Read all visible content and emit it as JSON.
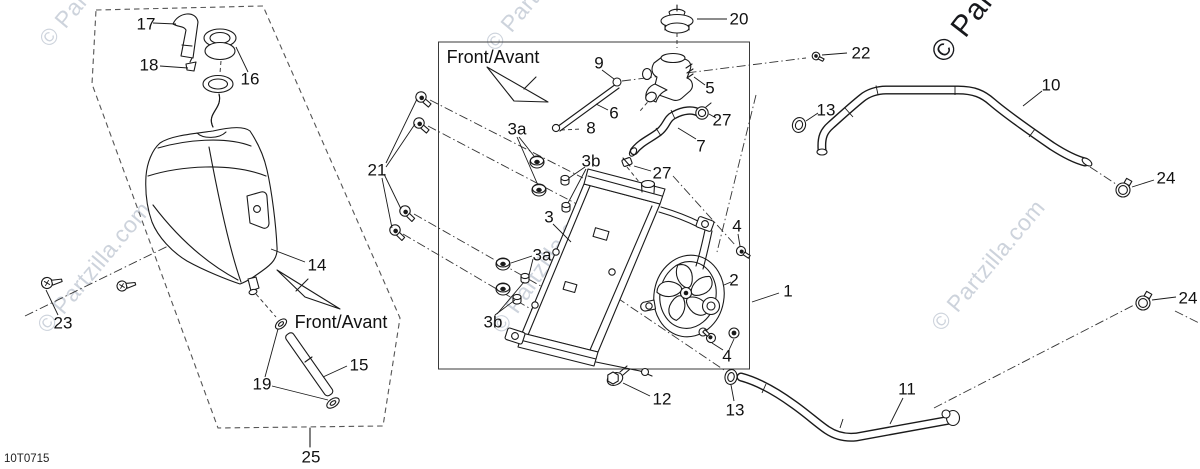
{
  "diagram": {
    "title_code": "10T0715",
    "watermark": "© Partzilla.com",
    "direction_label": "Front/Avant",
    "callouts": [
      "1",
      "2",
      "3",
      "3a",
      "3b",
      "4",
      "5",
      "6",
      "7",
      "8",
      "9",
      "10",
      "11",
      "12",
      "13",
      "14",
      "15",
      "16",
      "17",
      "18",
      "19",
      "20",
      "21",
      "22",
      "23",
      "24",
      "25",
      "27"
    ],
    "colors": {
      "background": "#ffffff",
      "line": "#1a1a1a",
      "watermark_light": "#cdd3dc",
      "watermark_dark": "#17181c"
    },
    "labels": [
      {
        "ref": "17",
        "text": "17"
      },
      {
        "ref": "18",
        "text": "18"
      },
      {
        "ref": "16",
        "text": "16"
      },
      {
        "ref": "14",
        "text": "14"
      },
      {
        "ref": "23",
        "text": "23"
      },
      {
        "ref": "19",
        "text": "19"
      },
      {
        "ref": "15",
        "text": "15"
      },
      {
        "ref": "25",
        "text": "25"
      },
      {
        "ref": "21",
        "text": "21"
      },
      {
        "ref": "front-avant-left",
        "text": "Front/Avant"
      },
      {
        "ref": "front-avant-center",
        "text": "Front/Avant"
      },
      {
        "ref": "20",
        "text": "20"
      },
      {
        "ref": "9",
        "text": "9"
      },
      {
        "ref": "6",
        "text": "6"
      },
      {
        "ref": "8",
        "text": "8"
      },
      {
        "ref": "5",
        "text": "5"
      },
      {
        "ref": "27-top",
        "text": "27"
      },
      {
        "ref": "27-mid",
        "text": "27"
      },
      {
        "ref": "7",
        "text": "7"
      },
      {
        "ref": "3a-top",
        "text": "3a"
      },
      {
        "ref": "3b-top",
        "text": "3b"
      },
      {
        "ref": "3",
        "text": "3"
      },
      {
        "ref": "3a-bottom",
        "text": "3a"
      },
      {
        "ref": "3b-bottom",
        "text": "3b"
      },
      {
        "ref": "2",
        "text": "2"
      },
      {
        "ref": "4-top",
        "text": "4"
      },
      {
        "ref": "4-bottom",
        "text": "4"
      },
      {
        "ref": "12",
        "text": "12"
      },
      {
        "ref": "13-bottom",
        "text": "13"
      },
      {
        "ref": "1",
        "text": "1"
      },
      {
        "ref": "22",
        "text": "22"
      },
      {
        "ref": "13-right",
        "text": "13"
      },
      {
        "ref": "10",
        "text": "10"
      },
      {
        "ref": "24-top",
        "text": "24"
      },
      {
        "ref": "24-bottom",
        "text": "24"
      },
      {
        "ref": "11",
        "text": "11"
      }
    ]
  }
}
